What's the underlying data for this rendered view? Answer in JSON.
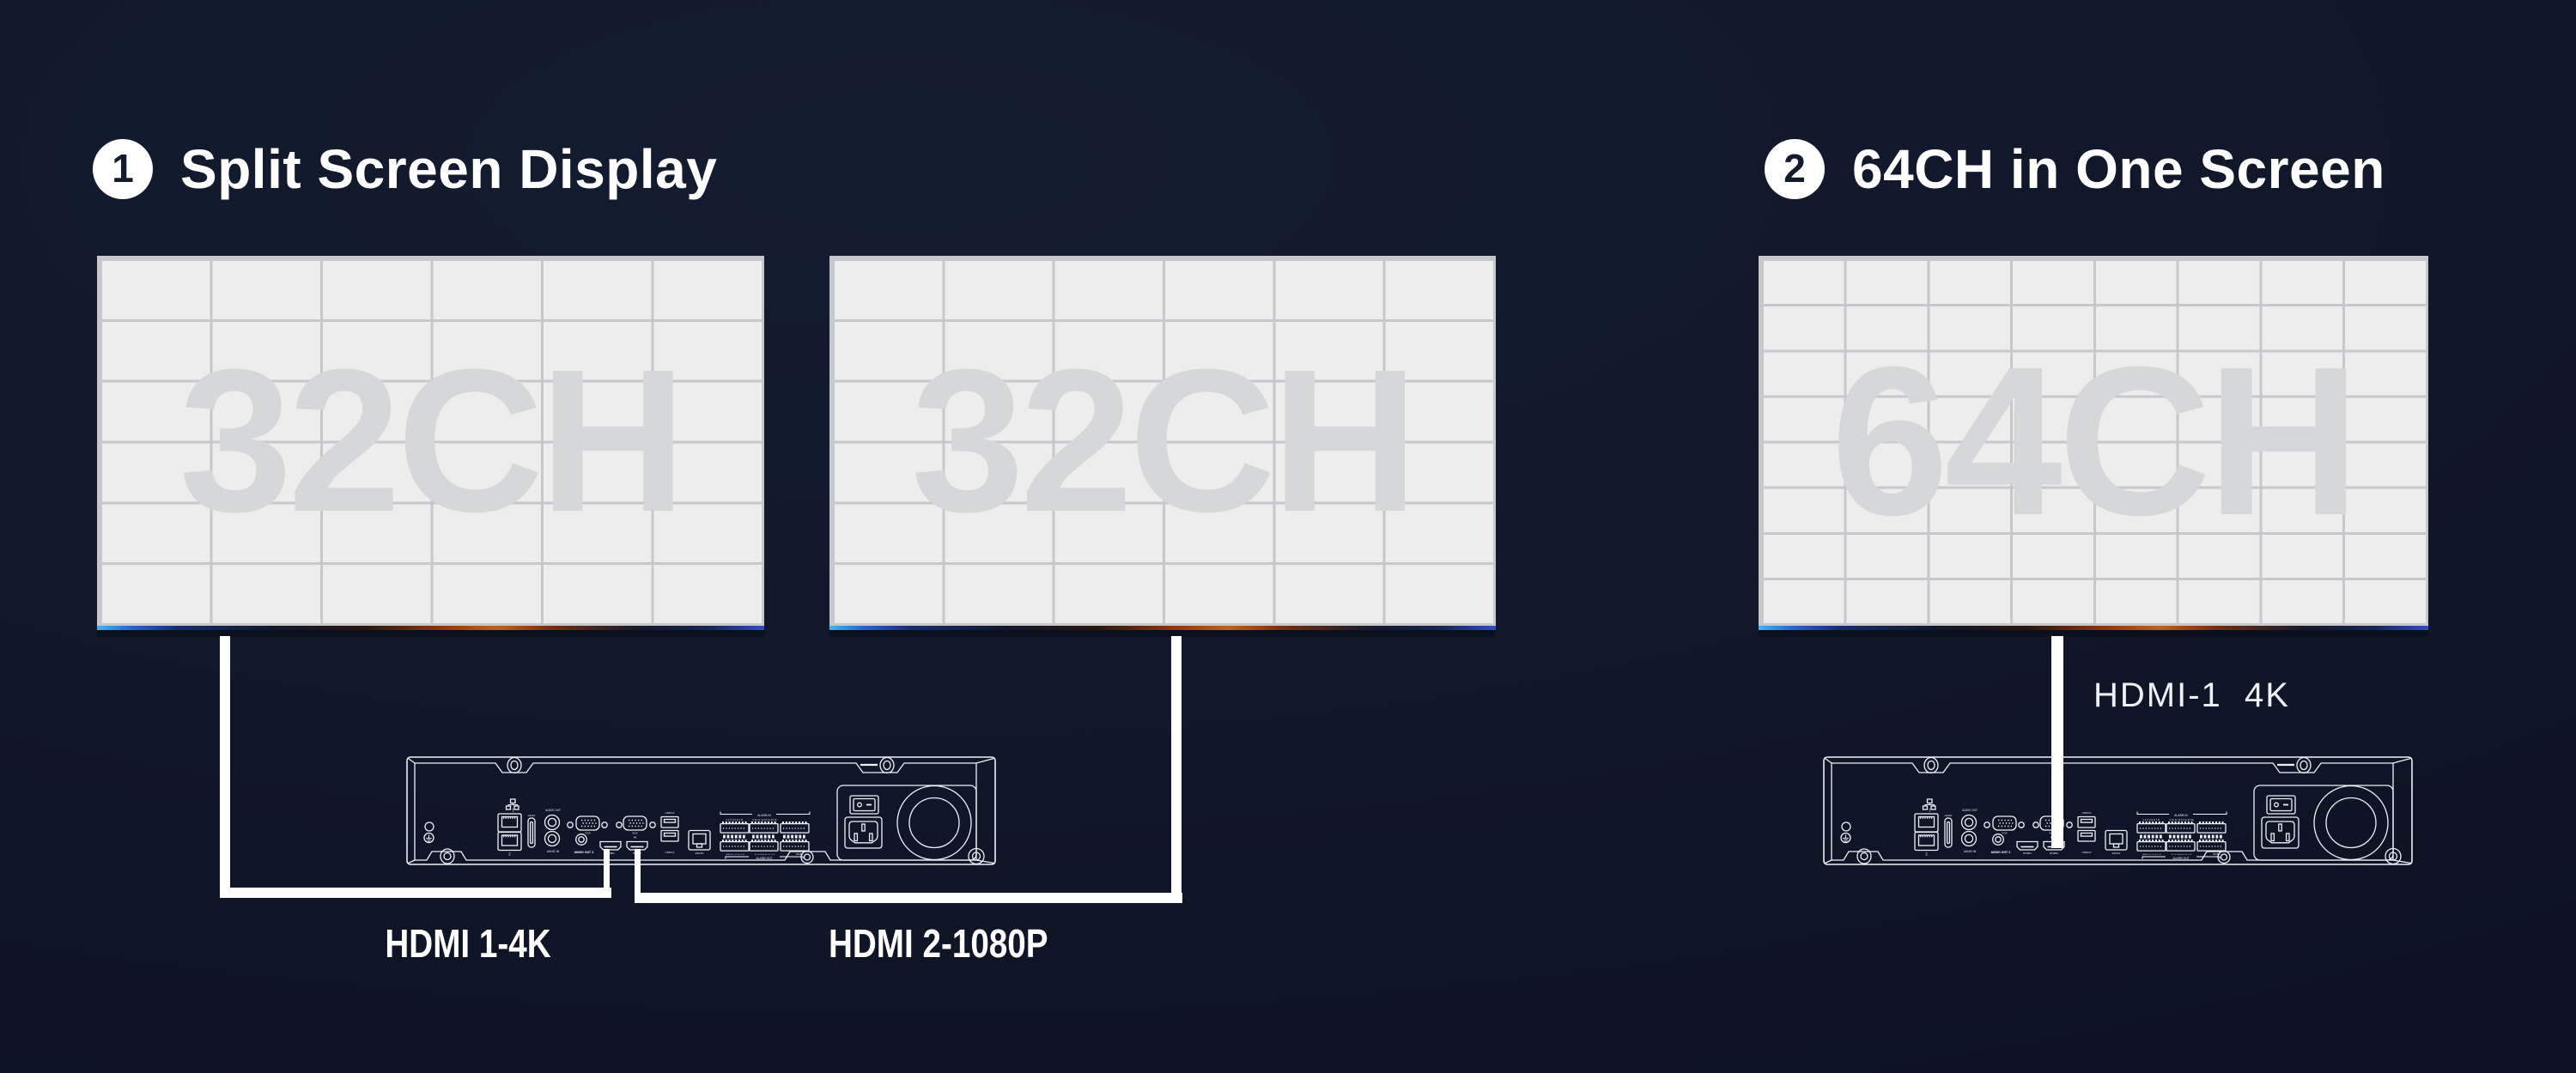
{
  "sections": [
    {
      "badge": "1",
      "title": "Split Screen Display",
      "screens": [
        {
          "watermark": "32CH",
          "grid_cols": 6,
          "grid_rows": 6
        },
        {
          "watermark": "32CH",
          "grid_cols": 6,
          "grid_rows": 6
        }
      ],
      "cables": [
        {
          "label": "HDMI 1-4K"
        },
        {
          "label": "HDMI 2-1080P"
        }
      ]
    },
    {
      "badge": "2",
      "title": "64CH in One Screen",
      "screens": [
        {
          "watermark": "64CH",
          "grid_cols": 8,
          "grid_rows": 8
        }
      ],
      "cables": [
        {
          "label": "HDMI-1  4K"
        }
      ]
    }
  ],
  "device": {
    "name": "NVR rear panel",
    "labels": {
      "net_id": "1",
      "lan2": "2",
      "esata": "eSATA",
      "audio_out": "AUDIO OUT",
      "audio_in": "AUDIO IN",
      "vga1": "VGA",
      "audio_out2": "AUDIO OUT 2",
      "hdmi1": "HDMI1",
      "vga2": "VGA",
      "vga2_res": "4K",
      "hdmi2": "HDMI2",
      "usb_top": "USB3.0",
      "usb_bottom": "USB3.0",
      "rs232": "RS232",
      "alarm_in": "ALARM IN",
      "alarm_nums_1_8": "1 2 3 4 5 6 7 8",
      "alarm_nums_9_16": "9 10 11 12 13 14 15 16",
      "alarm_pins_a": "A B G 1+ 1- 2+ 2- G",
      "alarm_pins_b": "3+ 3- G 4+ 4- C+ C- G",
      "rs485": "RS485",
      "alarm_out": "ALARM OUT"
    }
  },
  "colors": {
    "background": "#101729",
    "screen_bg": "#ededee",
    "grid_line": "#c6c8cb",
    "watermark": "#d6d7d9",
    "cable": "#ffffff",
    "line_art": "#edf1f7",
    "title_text": "#ffffff",
    "badge_bg": "#ffffff",
    "badge_text": "#141b2c",
    "screen_strip": [
      "#3fb7ea",
      "#2d62d6",
      "#8a3a15",
      "#c06020",
      "#2f4fc0"
    ]
  }
}
